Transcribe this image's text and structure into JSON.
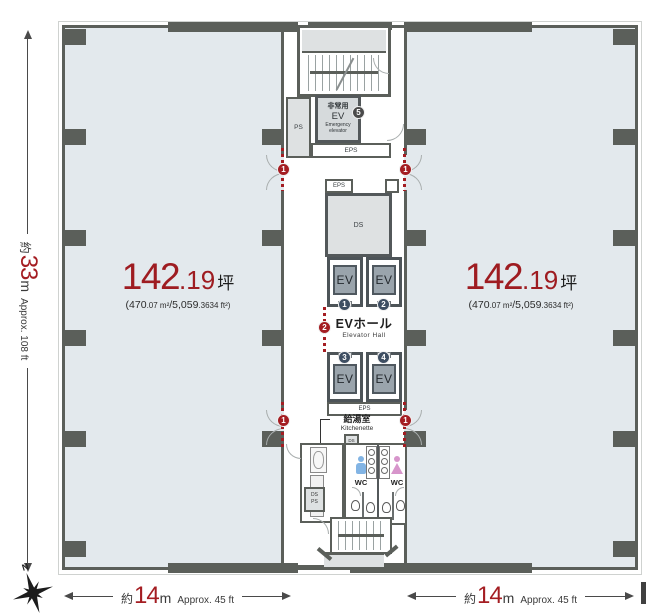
{
  "colors": {
    "accent_red": "#a41d22",
    "badge_navy": "#3e4e62",
    "badge_gray": "#4a4a4a",
    "wall": "#5b5f5a",
    "office_fill": "#e3e9ed",
    "male_blue": "#82b4e4",
    "female_pink": "#d795cb"
  },
  "areas": {
    "left": {
      "value": "142",
      "decimal": ".19",
      "unit": "坪",
      "sub1": "(470",
      "sub2": ".07 m²",
      "sub3": "/5,059",
      "sub4": ".3634 ft²)"
    },
    "right": {
      "value": "142",
      "decimal": ".19",
      "unit": "坪",
      "sub1": "(470",
      "sub2": ".07 m²",
      "sub3": "/5,059",
      "sub4": ".3634 ft²)"
    }
  },
  "dimensions": {
    "vertical": {
      "prefix": "約",
      "value": "33",
      "unit": "m",
      "approx": "Approx. 108 ft"
    },
    "bottom_left": {
      "prefix": "約",
      "value": "14",
      "unit": "m",
      "approx": "Approx. 45 ft"
    },
    "bottom_right": {
      "prefix": "約",
      "value": "14",
      "unit": "m",
      "approx": "Approx. 45 ft"
    }
  },
  "core": {
    "ps": "PS",
    "eps_top": "EPS",
    "eps_mid": "EPS",
    "eps_bottom": "EPS",
    "ds": "DS",
    "emergency_ev": {
      "jp1": "非常用",
      "jp2": "EV",
      "en1": "Emergency",
      "en2": "elevator",
      "badge": "5"
    },
    "elevators": [
      {
        "label": "EV",
        "badge": "1"
      },
      {
        "label": "EV",
        "badge": "2"
      },
      {
        "label": "EV",
        "badge": "3"
      },
      {
        "label": "EV",
        "badge": "4"
      }
    ],
    "ev_hall": {
      "jp": "EVホール",
      "en": "Elevator Hall"
    },
    "kitchenette": {
      "jp": "給湯室",
      "en": "Kitchenette"
    },
    "wc": {
      "male": "WC",
      "female": "WC"
    },
    "ds_ps_upper": {
      "l1": "DS",
      "l2": "PS"
    },
    "ds_ps_lower": {
      "l1": "DS",
      "l2": "PS"
    }
  },
  "openings": {
    "office_entrance": "1",
    "hall_entrance": "2"
  },
  "compass": {
    "north": "N"
  }
}
